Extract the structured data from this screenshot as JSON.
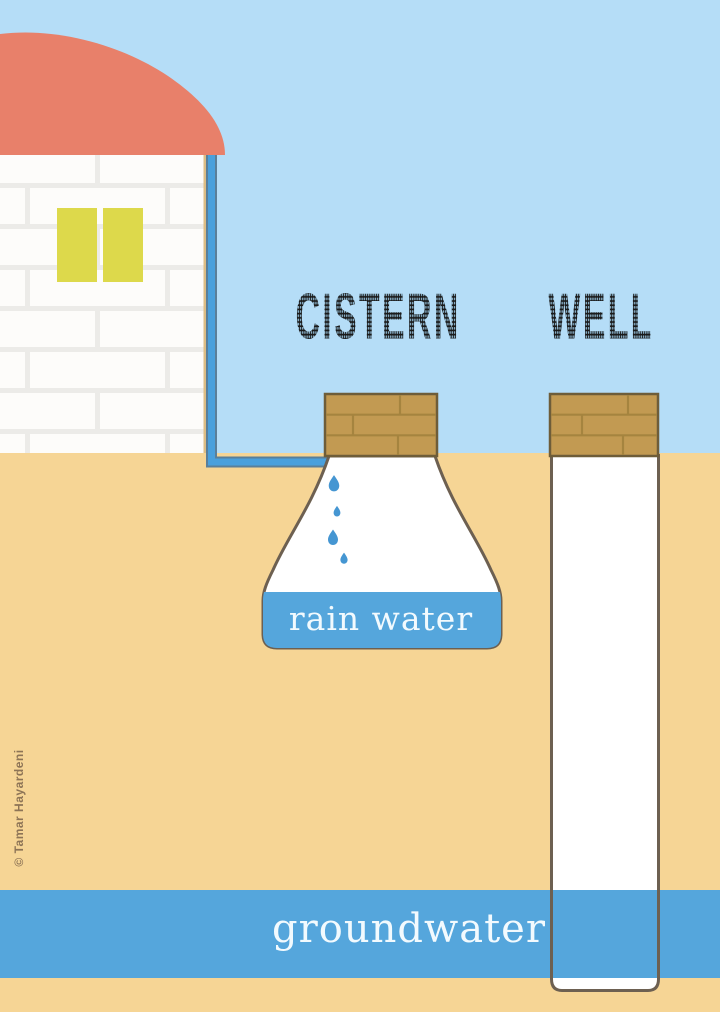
{
  "canvas": {
    "width": 720,
    "height": 1012
  },
  "titles": {
    "cistern": "CISTERN",
    "well": "WELL"
  },
  "labels": {
    "rain_water": "rain water",
    "groundwater": "groundwater"
  },
  "credit": {
    "text": "© Tamar Hayardeni"
  },
  "icons": {
    "droplet": "water-droplet-icon"
  },
  "colors": {
    "sky": "#b5ddf7",
    "sand": "#f6d595",
    "water": "#55a6dc",
    "roof": "#e8806a",
    "window": "#ddd94b",
    "wall": "#fdfcfa",
    "wall_mortar": "#ecebe8",
    "wall_edge": "#dcbd85",
    "brick": "#c29a52",
    "brick_mortar": "#a5843f",
    "brick_outline": "#6e5d39",
    "structure_outline": "#6d6051",
    "pipe": "#4aa0dc",
    "pipe_outline": "#5b7f99",
    "droplet": "#4596d2",
    "title_ink": "#1a1a1a",
    "label_text": "#f2fafe",
    "credit_text": "#8d7456"
  }
}
